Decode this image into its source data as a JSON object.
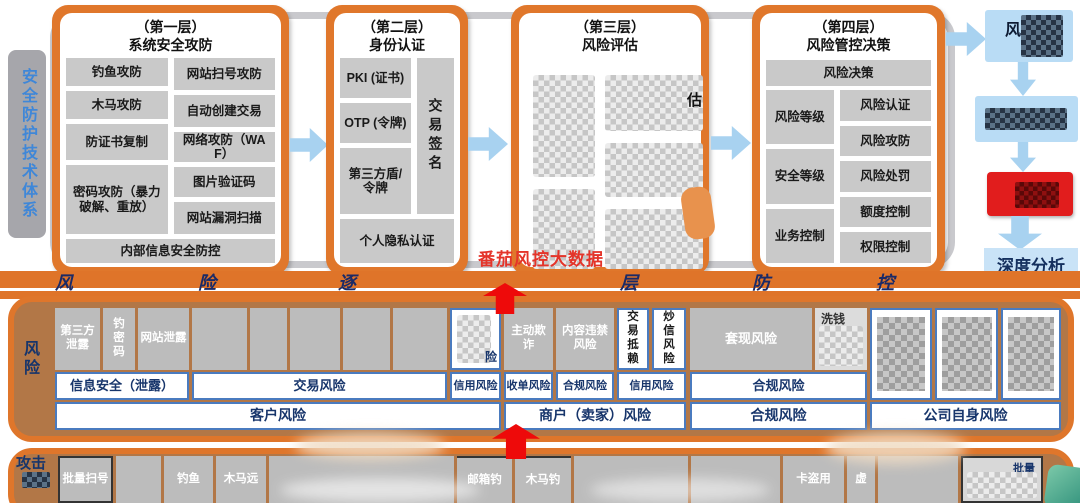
{
  "sidebar": {
    "label": "安全防护技术体系"
  },
  "watermark": "番茄风控大数据",
  "layers": [
    {
      "title1": "（第一层）",
      "title2": "系统安全攻防",
      "left": [
        "钓鱼攻防",
        "木马攻防",
        "防证书复制",
        "密码攻防（暴力破解、重放）"
      ],
      "right": [
        "网站扫号攻防",
        "自动创建交易",
        "网络攻防（WAF）",
        "图片验证码",
        "网站漏洞扫描"
      ],
      "bottom": "内部信息安全防控"
    },
    {
      "title1": "（第二层）",
      "title2": "身份认证",
      "left": [
        "PKI (证书)",
        "OTP (令牌)",
        "第三方盾/令牌"
      ],
      "side": "交易签名",
      "bottom": "个人隐私认证"
    },
    {
      "title1": "（第三层）",
      "title2": "风险评估",
      "partial_char": "估"
    },
    {
      "title1": "（第四层）",
      "title2": "风险管控决策",
      "top": "风险决策",
      "left": [
        "风险等级",
        "安全等级",
        "业务控制"
      ],
      "right": [
        "风险认证",
        "风险攻防",
        "风险处罚",
        "额度控制",
        "权限控制"
      ]
    }
  ],
  "flow": {
    "box1_char": "风",
    "deep_analysis": "深度分析"
  },
  "band": {
    "chars": [
      "风",
      "险",
      "逐",
      "层",
      "防",
      "控"
    ]
  },
  "risk": {
    "label": "风险",
    "row1": {
      "c1": "第三方泄露",
      "c2": "钓密码",
      "c3": "网站泄露",
      "c9_char": "险",
      "c10": "主动欺诈",
      "c11": "内容违禁风险",
      "c12": "交易抵赖",
      "c13": "炒信风险",
      "c14": "套现风险",
      "c15": "洗钱"
    },
    "categories": [
      "信息安全（泄露）",
      "交易风险",
      "信用风险",
      "收单风险",
      "合规风险",
      "信用风险",
      "合规风险"
    ],
    "groups": [
      "客户风险",
      "商户（卖家）风险",
      "合规风险",
      "公司自身风险"
    ]
  },
  "attack": {
    "label": "攻击",
    "items": [
      "批量扫号",
      "钓鱼",
      "木马远",
      "邮箱钓",
      "木马钓",
      "卡盗用",
      "虚",
      "批量"
    ]
  }
}
